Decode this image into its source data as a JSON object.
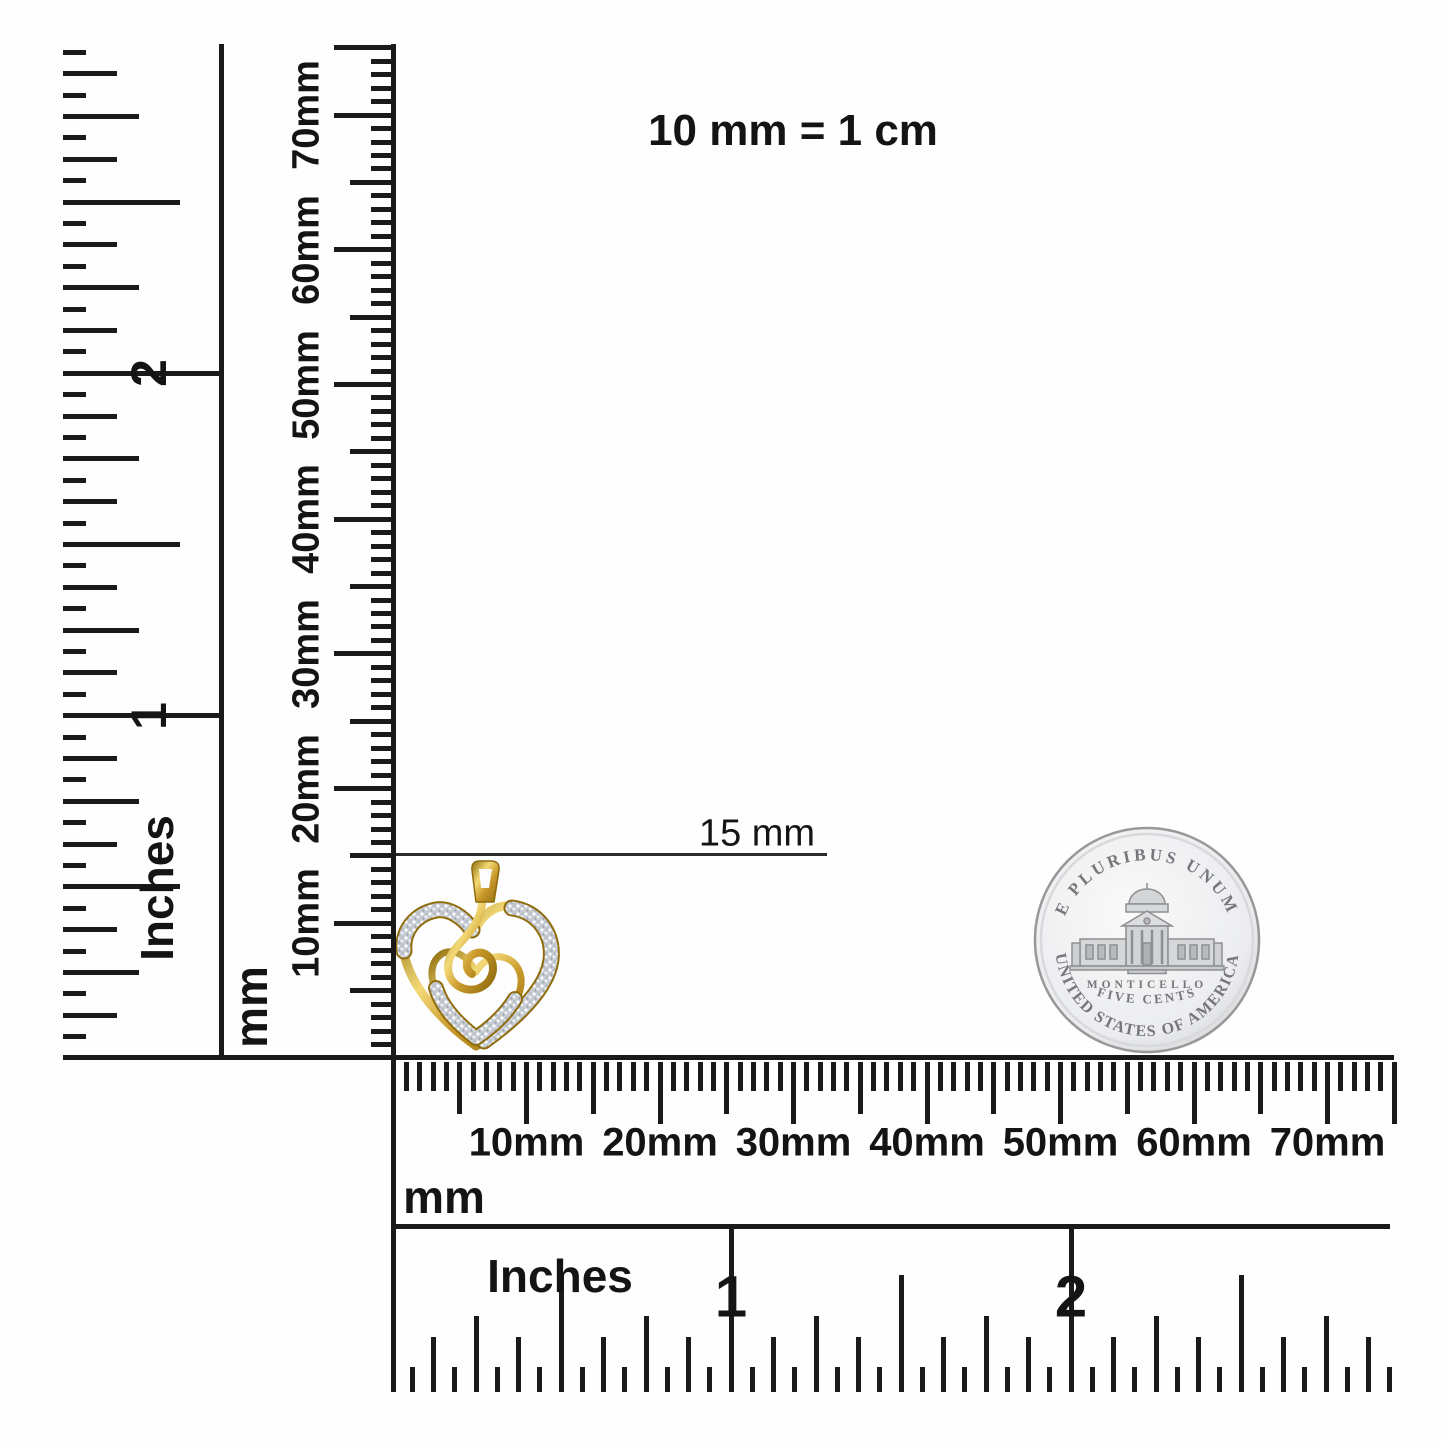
{
  "note": {
    "equivalence": "10 mm = 1 cm"
  },
  "size_indicator": {
    "label": "15 mm"
  },
  "rulers": {
    "left_inch": {
      "unit": "Inches",
      "marks": [
        "1",
        "2"
      ]
    },
    "left_mm": {
      "unit": "mm",
      "marks": [
        "10mm",
        "20mm",
        "30mm",
        "40mm",
        "50mm",
        "60mm",
        "70mm"
      ]
    },
    "bottom_mm": {
      "unit": "mm",
      "marks": [
        "10mm",
        "20mm",
        "30mm",
        "40mm",
        "50mm",
        "60mm",
        "70mm"
      ]
    },
    "bottom_inch": {
      "unit": "Inches",
      "marks": [
        "1",
        "2"
      ]
    }
  },
  "coin": {
    "motto": "E PLURIBUS UNUM",
    "building": "MONTICELLO",
    "denomination": "FIVE CENTS",
    "country": "UNITED STATES OF AMERICA",
    "colors": {
      "silver_light": "#fafafa",
      "silver_dark": "#c6c8ca",
      "relief": "#8d8f92",
      "text": "#75777a"
    }
  },
  "pendant": {
    "colors": {
      "gold": "#c9992b",
      "gold_light": "#f3d977",
      "gold_dark": "#8f6c0c",
      "pave": "#c7ccd3"
    }
  }
}
